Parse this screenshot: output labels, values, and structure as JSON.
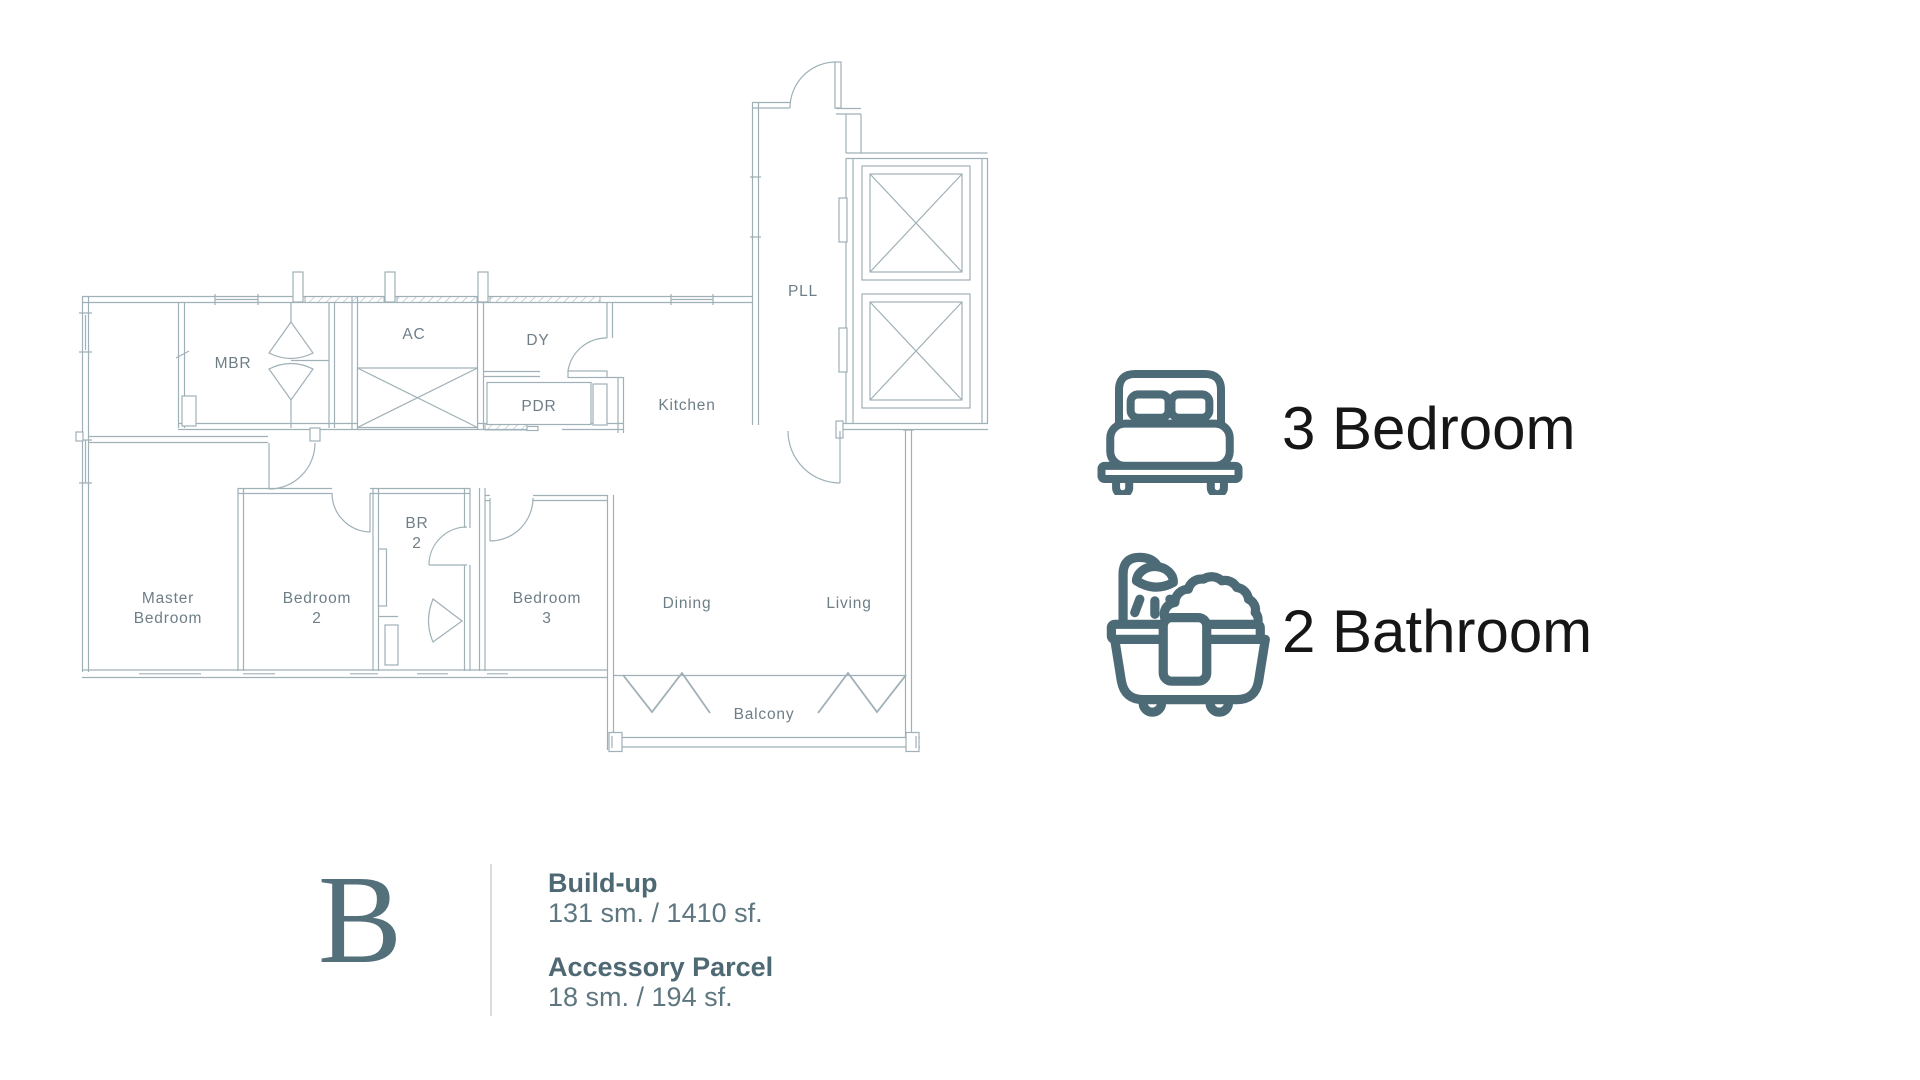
{
  "colors": {
    "plan_line": "#9fb0b7",
    "plan_label": "#6e7e87",
    "accent_icon": "#4d6b77",
    "feature_text": "#161616",
    "unit_text": "#5d7680",
    "type_letter_color": "#53707b"
  },
  "plan": {
    "rooms": [
      {
        "name": "MBR",
        "lines": [
          "MBR"
        ]
      },
      {
        "name": "AC",
        "lines": [
          "AC"
        ]
      },
      {
        "name": "DY",
        "lines": [
          "DY"
        ]
      },
      {
        "name": "PDR",
        "lines": [
          "PDR"
        ]
      },
      {
        "name": "Kitchen",
        "lines": [
          "Kitchen"
        ]
      },
      {
        "name": "PLL",
        "lines": [
          "PLL"
        ]
      },
      {
        "name": "Master Bedroom",
        "lines": [
          "Master",
          "Bedroom"
        ]
      },
      {
        "name": "Bedroom 2",
        "lines": [
          "Bedroom",
          "2"
        ]
      },
      {
        "name": "BR 2",
        "lines": [
          "BR",
          "2"
        ]
      },
      {
        "name": "Bedroom 3",
        "lines": [
          "Bedroom",
          "3"
        ]
      },
      {
        "name": "Dining",
        "lines": [
          "Dining"
        ]
      },
      {
        "name": "Living",
        "lines": [
          "Living"
        ]
      },
      {
        "name": "Balcony",
        "lines": [
          "Balcony"
        ]
      }
    ]
  },
  "features": [
    {
      "icon": "bed-icon",
      "label": "3 Bedroom"
    },
    {
      "icon": "bathtub-icon",
      "label": "2 Bathroom"
    }
  ],
  "unit": {
    "type_letter": "B",
    "details": [
      {
        "heading": "Build-up",
        "value": "131 sm. / 1410 sf."
      },
      {
        "heading": "Accessory Parcel",
        "value": "18 sm. / 194 sf."
      }
    ]
  }
}
